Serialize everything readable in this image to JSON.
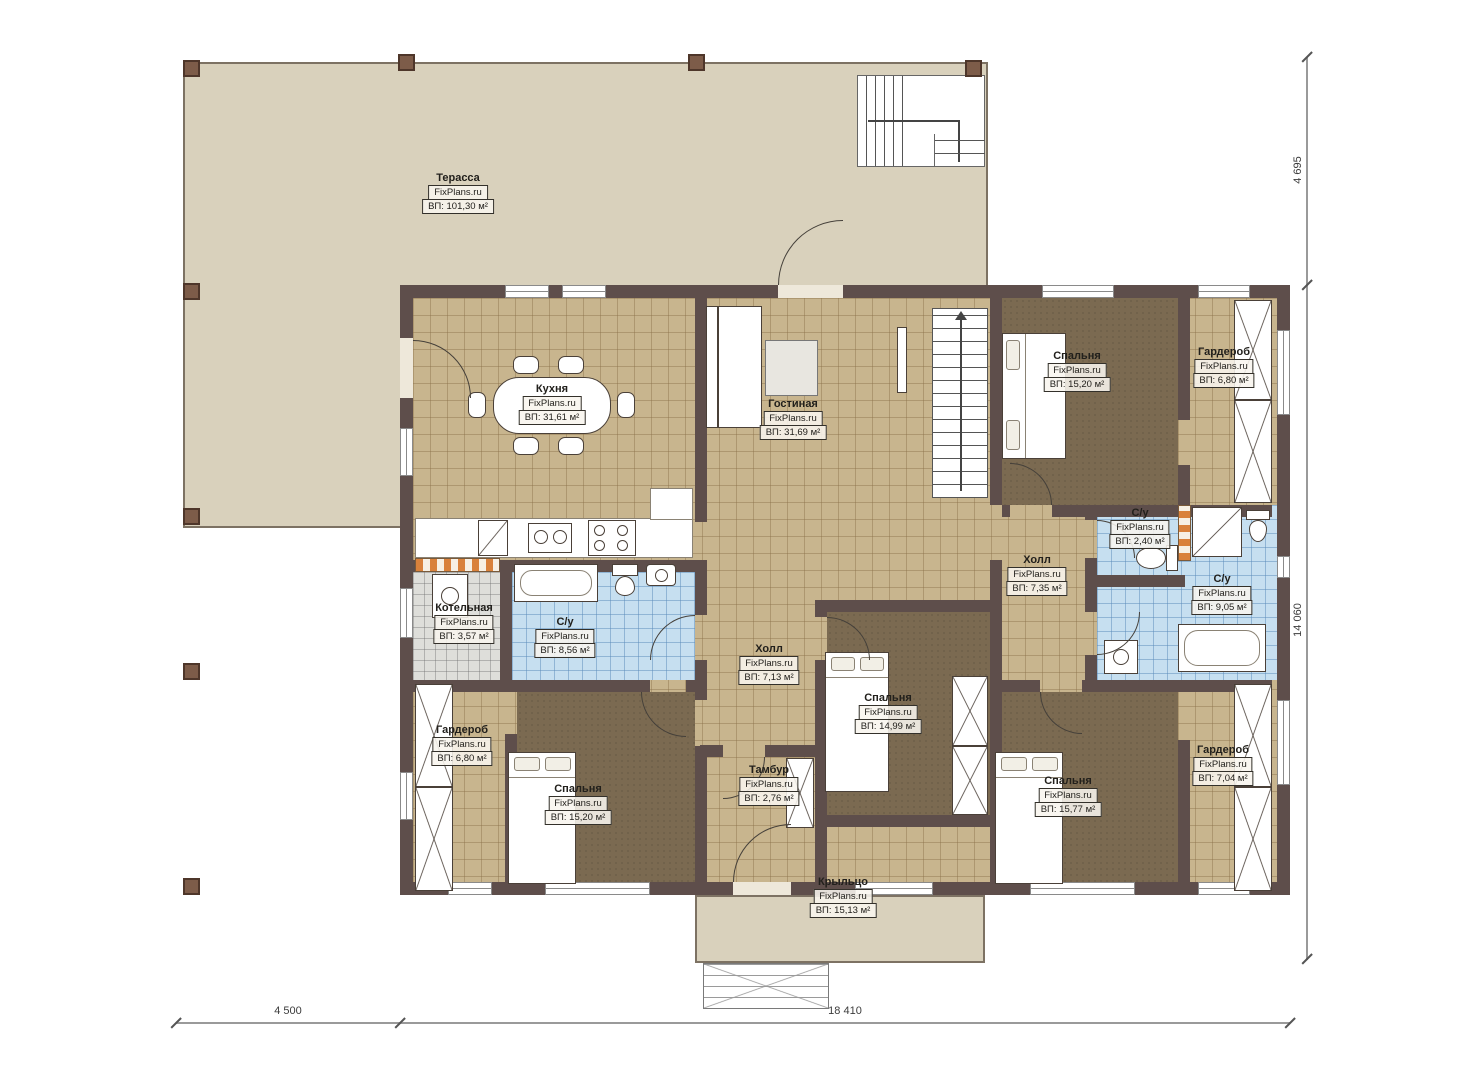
{
  "watermark": "FixPlans.ru",
  "rooms": [
    {
      "id": "terrace",
      "name": "Терасса",
      "area": "ВП: 101,30 м²"
    },
    {
      "id": "kitchen",
      "name": "Кухня",
      "area": "ВП: 31,61 м²"
    },
    {
      "id": "living",
      "name": "Гостиная",
      "area": "ВП: 31,69 м²"
    },
    {
      "id": "bedroom-top-right",
      "name": "Спальня",
      "area": "ВП: 15,20 м²"
    },
    {
      "id": "wardrobe-top-right",
      "name": "Гардероб",
      "area": "ВП: 6,80 м²"
    },
    {
      "id": "hall-right",
      "name": "Холл",
      "area": "ВП: 7,35 м²"
    },
    {
      "id": "wc-small",
      "name": "С/у",
      "area": "ВП: 2,40 м²"
    },
    {
      "id": "wc-right",
      "name": "С/у",
      "area": "ВП: 9,05 м²"
    },
    {
      "id": "boiler",
      "name": "Котельная",
      "area": "ВП: 3,57 м²"
    },
    {
      "id": "wc-middle",
      "name": "С/у",
      "area": "ВП: 8,56 м²"
    },
    {
      "id": "hall-center",
      "name": "Холл",
      "area": "ВП: 7,13 м²"
    },
    {
      "id": "bedroom-center",
      "name": "Спальня",
      "area": "ВП: 14,99 м²"
    },
    {
      "id": "tambour",
      "name": "Тамбур",
      "area": "ВП: 2,76 м²"
    },
    {
      "id": "wardrobe-bottom-left",
      "name": "Гардероб",
      "area": "ВП: 6,80 м²"
    },
    {
      "id": "bedroom-bottom-left",
      "name": "Спальня",
      "area": "ВП: 15,20 м²"
    },
    {
      "id": "bedroom-bottom-right",
      "name": "Спальня",
      "area": "ВП: 15,77 м²"
    },
    {
      "id": "wardrobe-bottom-right",
      "name": "Гардероб",
      "area": "ВП: 7,04 м²"
    },
    {
      "id": "porch",
      "name": "Крыльцо",
      "area": "ВП: 15,13 м²"
    }
  ],
  "dimensions": {
    "terrace_height": "4 695",
    "house_height": "14 060",
    "terrace_width": "4 500",
    "house_width": "18 410"
  },
  "colors": {
    "wall": "#5e4e4b",
    "terrace_floor": "#d9d1bc",
    "tile_floor": "#c8b58e",
    "bedroom_floor": "#7b6a51",
    "bath_floor": "#c6dff0",
    "boiler_floor": "#dededa",
    "accent_orange": "#d9813b"
  }
}
